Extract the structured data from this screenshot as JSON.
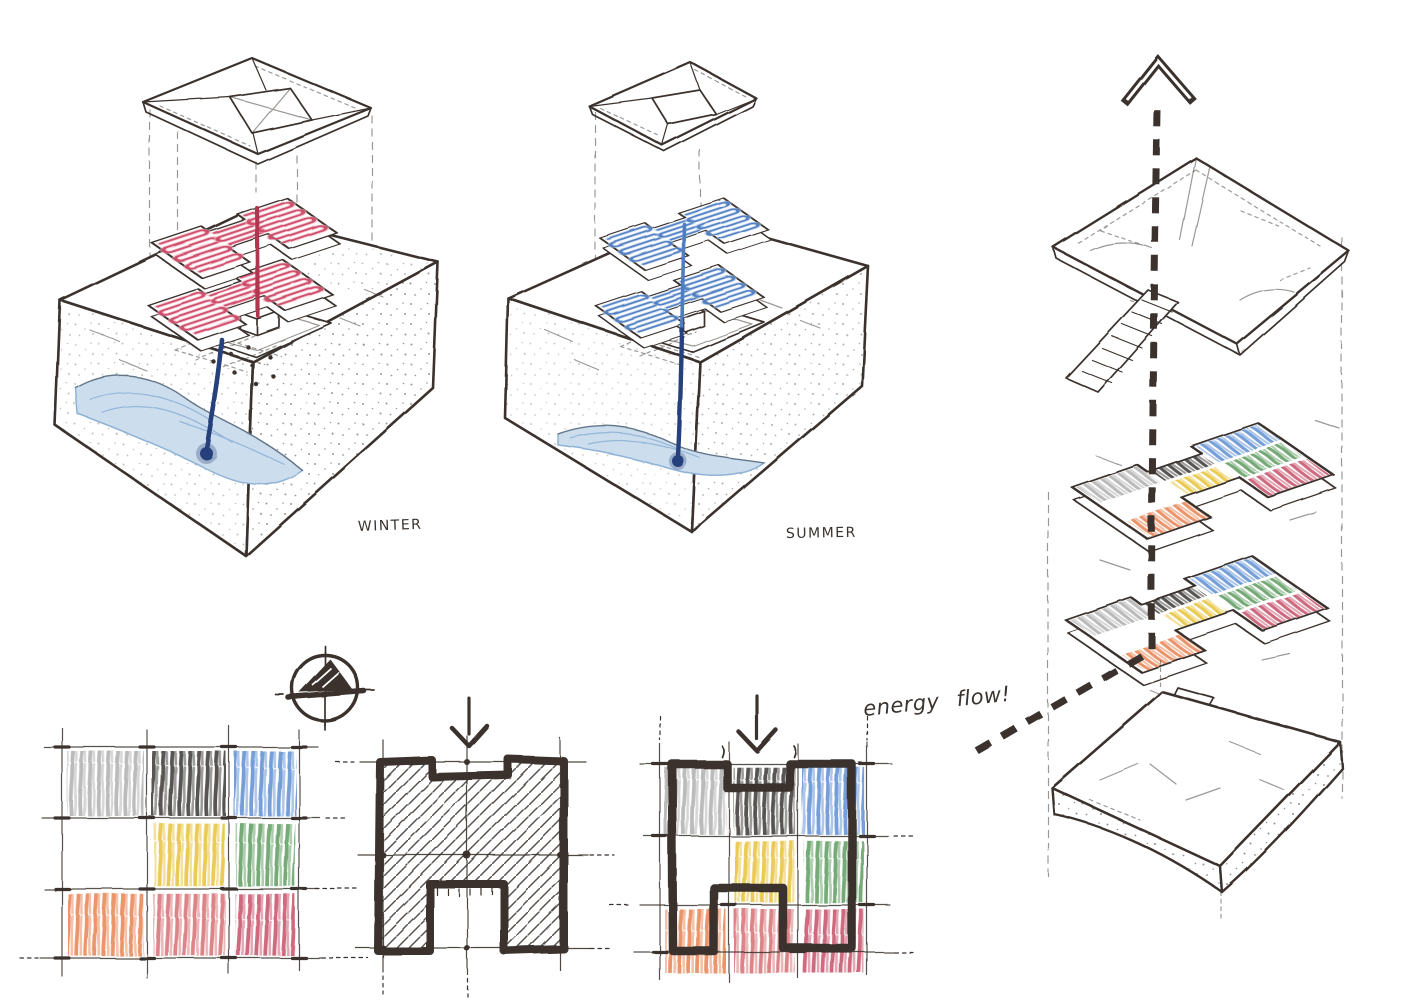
{
  "labels": {
    "winter": "WINTER",
    "summer": "SUMMER",
    "energy_flow": "energy flow!"
  },
  "palette": {
    "paper": "#ffffff",
    "ink": "#3a332e",
    "winter_coil": "#cf4a68",
    "winter_coil_halo": "#edaab8",
    "summer_coil": "#4f7dc2",
    "summer_coil_halo": "#adc6e6",
    "supply_line_warm": "#b23450",
    "ground_pipe": "#27417c",
    "river_fill": "#ccdded",
    "river_stroke": "#8fb3d6"
  },
  "crayon_colors": {
    "gray": "#9b9b9b",
    "black": "#3a3734",
    "blue": "#5d8ed2",
    "yellow": "#e7c238",
    "green": "#5d9b5f",
    "orange": "#e88352",
    "red": "#d66f73",
    "crimson": "#c65069"
  },
  "zoning_rows": [
    [
      "gray",
      "black",
      "blue"
    ],
    [
      "none",
      "yellow",
      "green"
    ],
    [
      "orange",
      "red",
      "crimson"
    ]
  ]
}
